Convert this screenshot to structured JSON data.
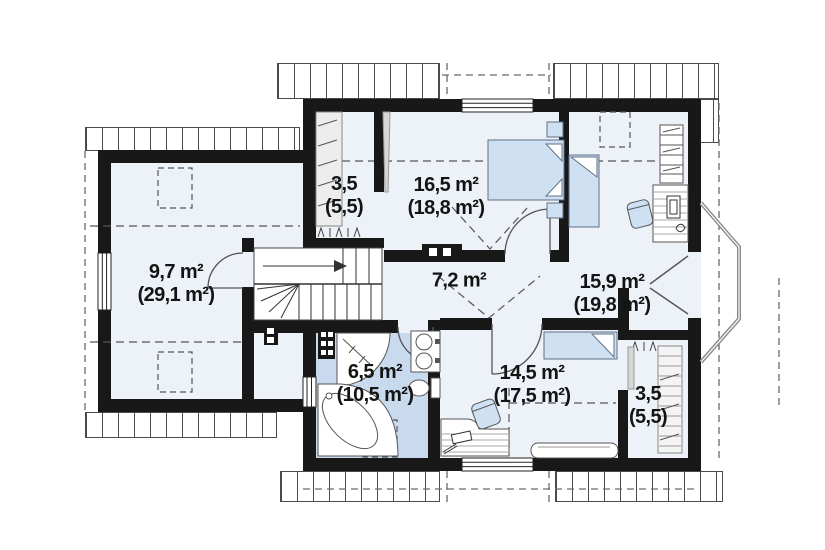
{
  "plan": {
    "type": "floor-plan",
    "floor_label": "attic floor",
    "colors": {
      "wall": "#181818",
      "floor": "#edf1f8",
      "bathroom_floor": "#c9daee",
      "furniture_fill": "#cfe0f3",
      "roof_hatch_line": "#4a4a4a",
      "dash_line": "#666666"
    },
    "rooms": [
      {
        "id": "room-9-7",
        "area": "9,7 m²",
        "area_total": "(29,1 m²)"
      },
      {
        "id": "wardrobe-top",
        "area": "3,5",
        "area_total": "(5,5)"
      },
      {
        "id": "bedroom-16-5",
        "area": "16,5 m²",
        "area_total": "(18,8 m²)"
      },
      {
        "id": "hall-7-2",
        "area": "7,2 m²",
        "area_total": ""
      },
      {
        "id": "room-15-9",
        "area": "15,9 m²",
        "area_total": "(19,8 m²)"
      },
      {
        "id": "bathroom-6-5",
        "area": "6,5 m²",
        "area_total": "(10,5 m²)"
      },
      {
        "id": "room-14-5",
        "area": "14,5 m²",
        "area_total": "(17,5 m²)"
      },
      {
        "id": "wardrobe-bottom",
        "area": "3,5",
        "area_total": "(5,5)"
      }
    ]
  }
}
